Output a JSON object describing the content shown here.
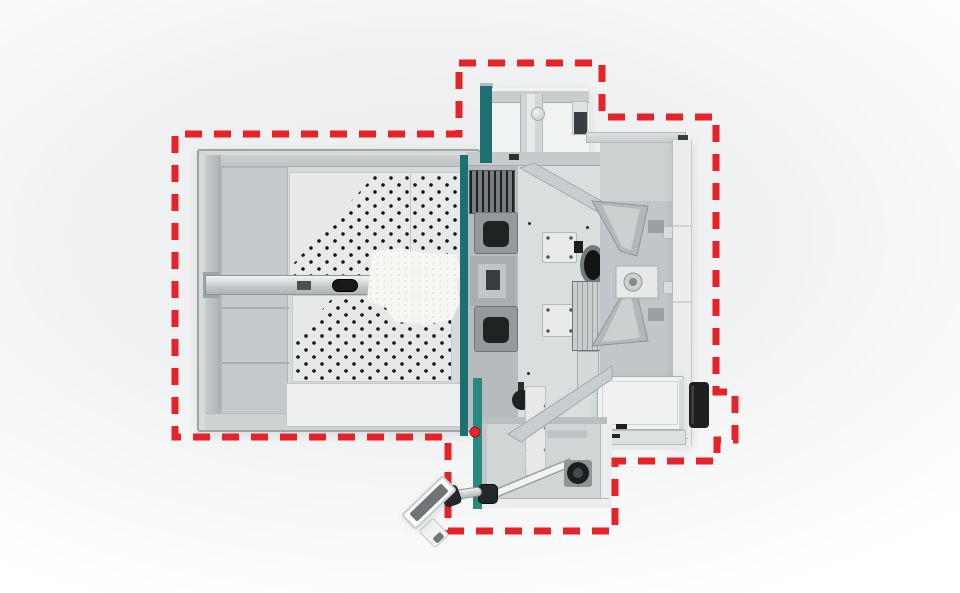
{
  "diagram": {
    "subject": "machine-top-view-footprint",
    "footprint_boundary": {
      "path": "M459 63 H602 V117 H716 V392 H735 V440 H717 V461 H615 V531 H448 V437 H175 V134 H459 Z",
      "dash_pattern": "17 12",
      "stroke_width": "7"
    }
  },
  "colors": {
    "boundary_red": "#e52329",
    "estop_red": "#e8262c",
    "accent_teal": "#1e6f72",
    "accent_teal_bright": "#27897f",
    "background_gray": "#e9ebec",
    "machine_light": "#e9ebeb",
    "machine_mid": "#c6cacb",
    "machine_dark": "#2b2e30"
  }
}
